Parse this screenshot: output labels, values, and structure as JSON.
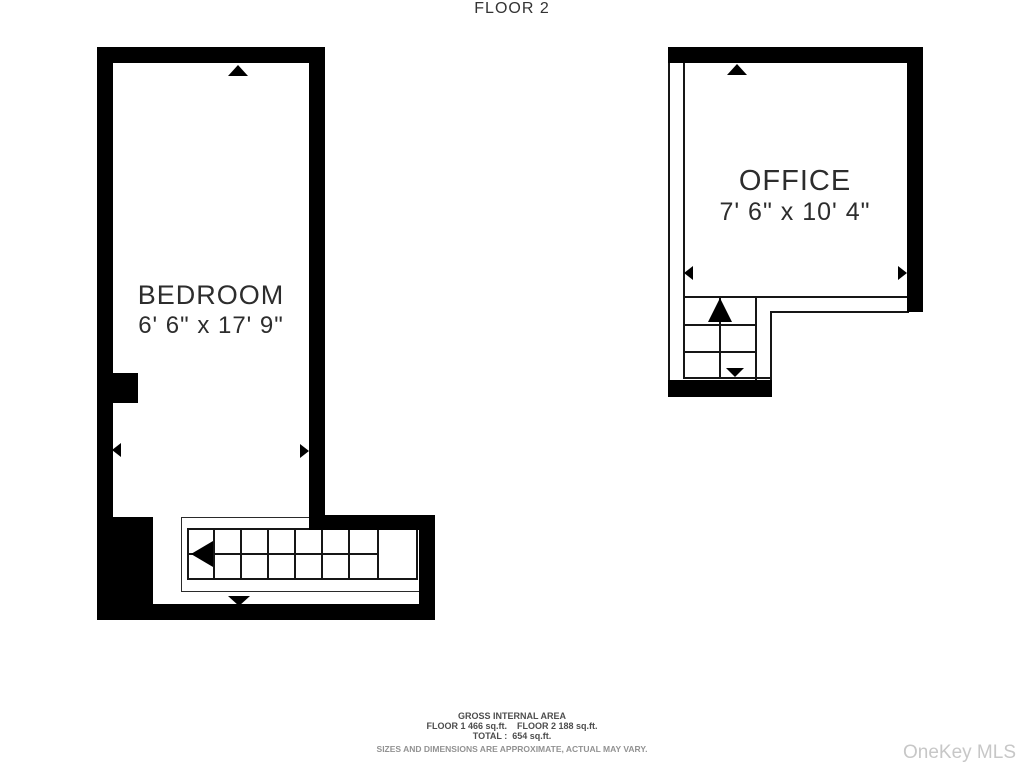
{
  "floorplan": {
    "floor_label": "FLOOR 2",
    "rooms": [
      {
        "name": "BEDROOM",
        "dimensions": "6' 6\" x 17' 9\""
      },
      {
        "name": "OFFICE",
        "dimensions": "7' 6\" x 10' 4\""
      }
    ],
    "footer": {
      "line1": "GROSS INTERNAL AREA",
      "line2": "FLOOR 1 466 sq.ft.    FLOOR 2 188 sq.ft.",
      "line3": "TOTAL :  654 sq.ft.",
      "disclaimer": "SIZES AND DIMENSIONS ARE APPROXIMATE, ACTUAL MAY VARY."
    },
    "watermark": "OneKey MLS",
    "colors": {
      "wall": "#000000",
      "text": "#2d2d2d",
      "footer_text": "#4d4d4d",
      "disclaimer": "#929292",
      "watermark": "#c7c7c7",
      "background": "#ffffff"
    }
  }
}
